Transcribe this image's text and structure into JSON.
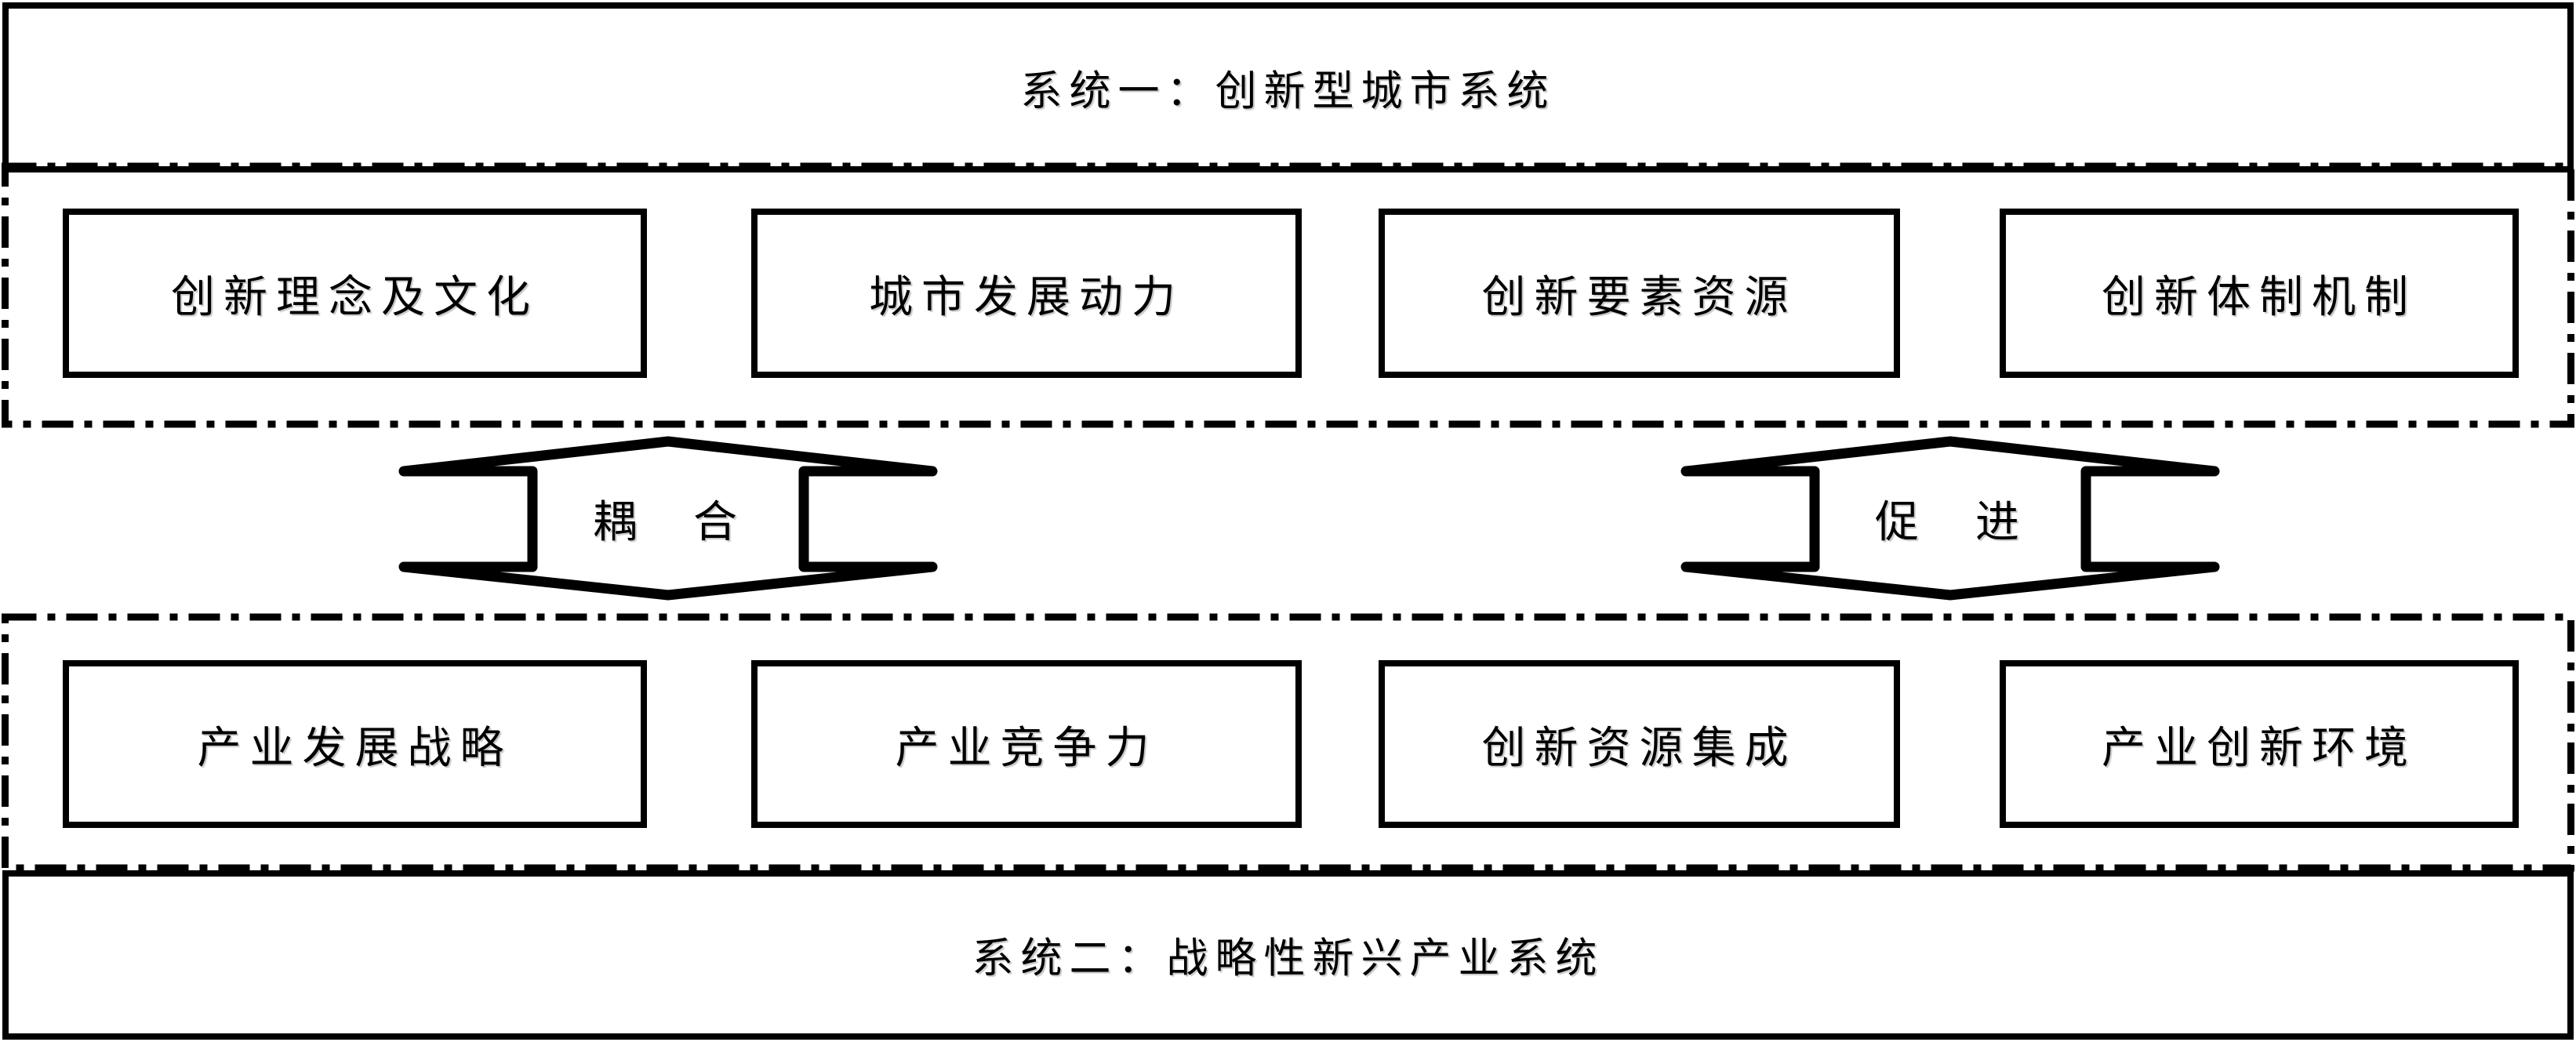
{
  "diagram": {
    "system1": {
      "title": "系统一：创新型城市系统",
      "components": [
        "创新理念及文化",
        "城市发展动力",
        "创新要素资源",
        "创新体制机制"
      ]
    },
    "system2": {
      "title": "系统二：战略性新兴产业系统",
      "components": [
        "产业发展战略",
        "产业竞争力",
        "创新资源集成",
        "产业创新环境"
      ]
    },
    "connectors": [
      {
        "label": "耦　合"
      },
      {
        "label": "促　进"
      }
    ],
    "colors": {
      "ink": "#000000",
      "background": "#ffffff"
    }
  }
}
